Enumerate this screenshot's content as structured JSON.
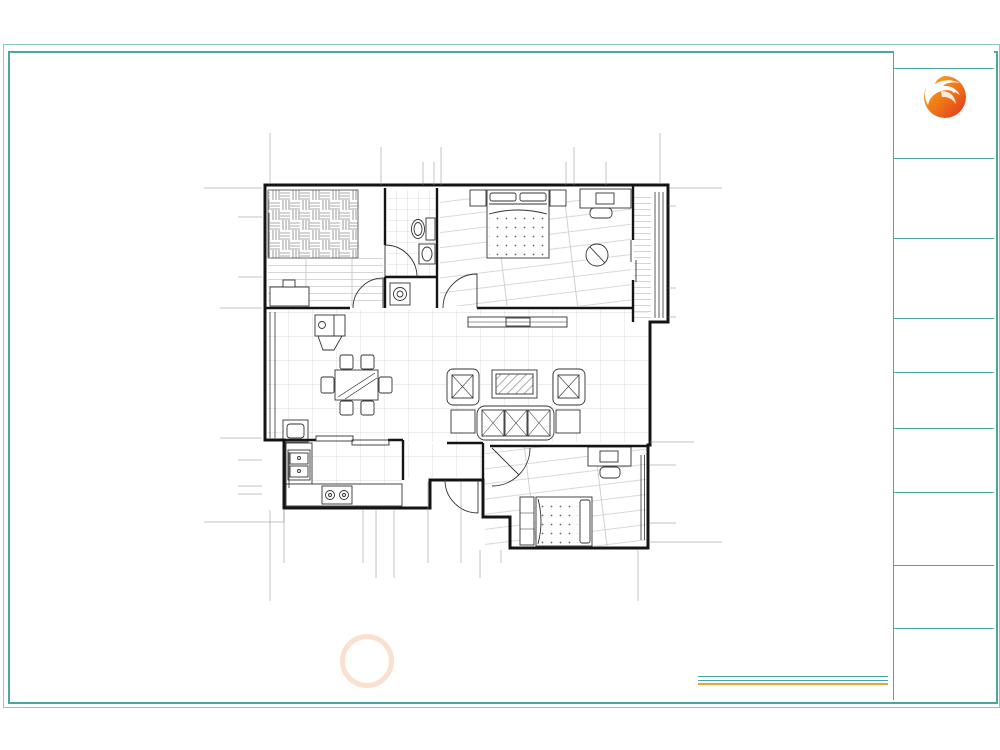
{
  "page": {
    "autodesk_stamp": "由 Autodesk 教育版产品制作",
    "footer_drawing_label": "平面布局图",
    "watermark_cn": "林凤装饰"
  },
  "title_block": {
    "top_left": "设计师姓名:",
    "top_right": "Tel: Ch",
    "logo_cn": "林凤装饰",
    "logo_en": "Linfeng Decoration",
    "project_label": "工程名称:",
    "project_sub": "Project Name",
    "notes_label": "备  注:",
    "notes_text": "本图所注尺寸均以现场实际尺寸为准，施工前请仔细核对；未经许可不得擅自复制、修改本图纸；如有疑问请及时与设计师联系确认。",
    "drawing_name_label": "图 名:",
    "drawing_name": "平面布局图",
    "paper_label": "图纸规格:",
    "paper_size": "A1",
    "designer_label": "设计师姓名 :",
    "review_label": "审  核:",
    "date_label": "打印日期:",
    "number_label": "图纸编号:"
  },
  "dimensions": {
    "top": {
      "overall": "11462",
      "row1": [
        "3220",
        "1760",
        "3860",
        "2262"
      ],
      "row2": [
        "3220",
        "1199",
        "321",
        "3860",
        "1164",
        "798"
      ]
    },
    "bottom": {
      "row1": [
        "400",
        "2287",
        "373",
        "529",
        "990",
        "941",
        "1152",
        "3458"
      ],
      "row2": [
        "3060",
        "2460",
        "4610"
      ],
      "overall": "10610"
    },
    "left": {
      "overall": "11160",
      "row1": [
        "3660",
        "3960",
        "1710",
        "1000"
      ],
      "row2": [
        "884",
        "1827",
        "949",
        "3960",
        "661",
        "794",
        "252",
        "1000"
      ],
      "inner": "1770"
    },
    "right": {
      "overall": "11160",
      "row1": [
        "3065",
        "891",
        "3811",
        "3060"
      ],
      "row2": [
        "543",
        "2522",
        "891",
        "3811",
        "706",
        "1760",
        "591"
      ]
    }
  },
  "colors": {
    "frame_teal": "#49a79e",
    "accent_teal": "#2e9a90",
    "logo_orange": "#f07818",
    "stamp_black": "#000000"
  }
}
